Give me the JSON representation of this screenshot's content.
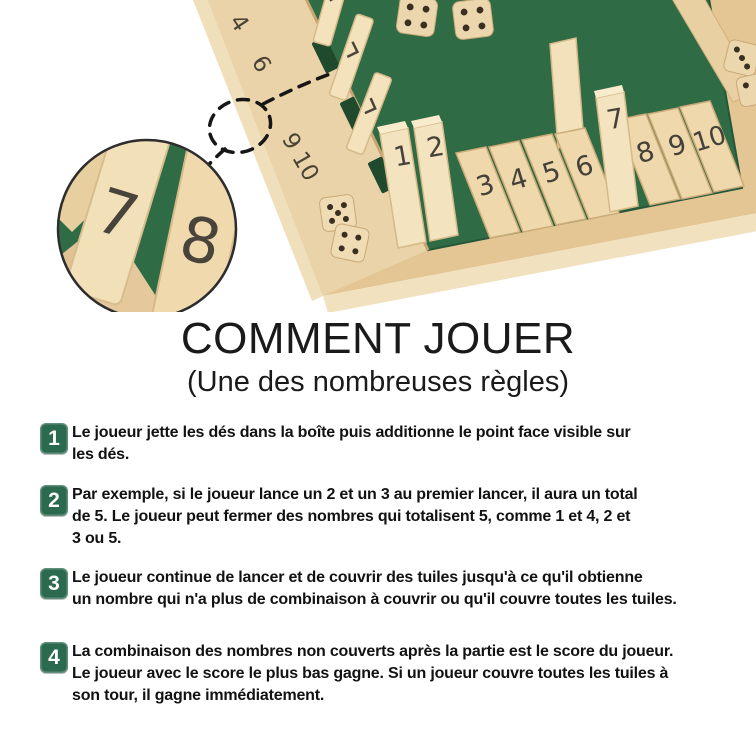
{
  "colors": {
    "accent_green": "#2B6A4F",
    "felt_green": "#2F6B44",
    "wood_light": "#F2E1BB",
    "wood_mid": "#E4C694",
    "wood_shadow": "#C7A671",
    "text": "#121212"
  },
  "icons": {
    "die": "rounded-square-with-pips",
    "magnifier_ellipse": "dashed-ellipse",
    "tile_chevron": "›"
  },
  "hero": {
    "rail_left": [
      "4",
      "6",
      "9",
      "10"
    ],
    "front": [
      "1",
      "2",
      "3",
      "4",
      "5",
      "6",
      "7",
      "8",
      "9",
      "10"
    ],
    "inset": [
      "7",
      "8"
    ]
  },
  "title": {
    "heading": "COMMENT JOUER",
    "subheading": "(Une des nombreuses règles)"
  },
  "steps": [
    {
      "num": "1",
      "lines": [
        "Le joueur jette les dés dans la boîte puis additionne le point face visible sur",
        "les dés."
      ]
    },
    {
      "num": "2",
      "lines": [
        "Par exemple, si le joueur lance un 2 et un 3 au premier lancer, il aura un total",
        "de 5. Le joueur peut fermer des nombres qui totalisent 5, comme 1 et 4, 2 et",
        "3 ou 5."
      ]
    },
    {
      "num": "3",
      "lines": [
        "Le joueur continue de lancer et de couvrir des tuiles jusqu'à ce qu'il obtienne",
        "un nombre qui n'a plus de combinaison à couvrir ou qu'il couvre toutes les tuiles."
      ]
    },
    {
      "num": "4",
      "lines": [
        "La combinaison des nombres non couverts après la partie est le score du joueur.",
        "Le joueur avec le score le plus bas gagne. Si un joueur couvre toutes les tuiles à",
        "son tour, il gagne immédiatement."
      ]
    }
  ]
}
